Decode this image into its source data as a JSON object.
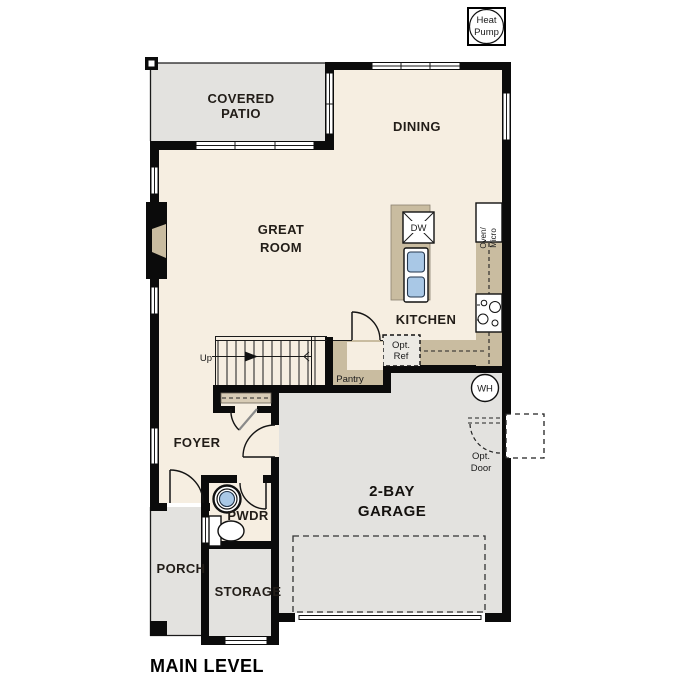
{
  "plan": {
    "title": "MAIN LEVEL",
    "heat_pump_badge": {
      "line1": "Heat",
      "line2": "Pump"
    }
  },
  "rooms": {
    "covered_patio": {
      "line1": "COVERED",
      "line2": "PATIO"
    },
    "dining": {
      "label": "DINING"
    },
    "great_room": {
      "line1": "GREAT",
      "line2": "ROOM"
    },
    "kitchen": {
      "label": "KITCHEN"
    },
    "pantry": {
      "label": "Pantry"
    },
    "foyer": {
      "label": "FOYER"
    },
    "powder": {
      "label": "PWDR"
    },
    "porch": {
      "label": "PORCH"
    },
    "storage": {
      "label": "STORAGE"
    },
    "garage": {
      "line1": "2-BAY",
      "line2": "GARAGE"
    }
  },
  "fixtures": {
    "up": "Up",
    "dishwasher": "DW",
    "oven_micro": {
      "line1": "Oven/",
      "line2": "Micro"
    },
    "opt_ref": {
      "line1": "Opt.",
      "line2": "Ref"
    },
    "water_heater": "WH",
    "opt_door": {
      "line1": "Opt.",
      "line2": "Door"
    }
  },
  "colors": {
    "wall": "#0b0b0b",
    "interior_floor": "#f6eee1",
    "exterior_floor": "#e3e2df",
    "counter": "#c9bca0",
    "fixture_blue": "#a9c8e6"
  }
}
